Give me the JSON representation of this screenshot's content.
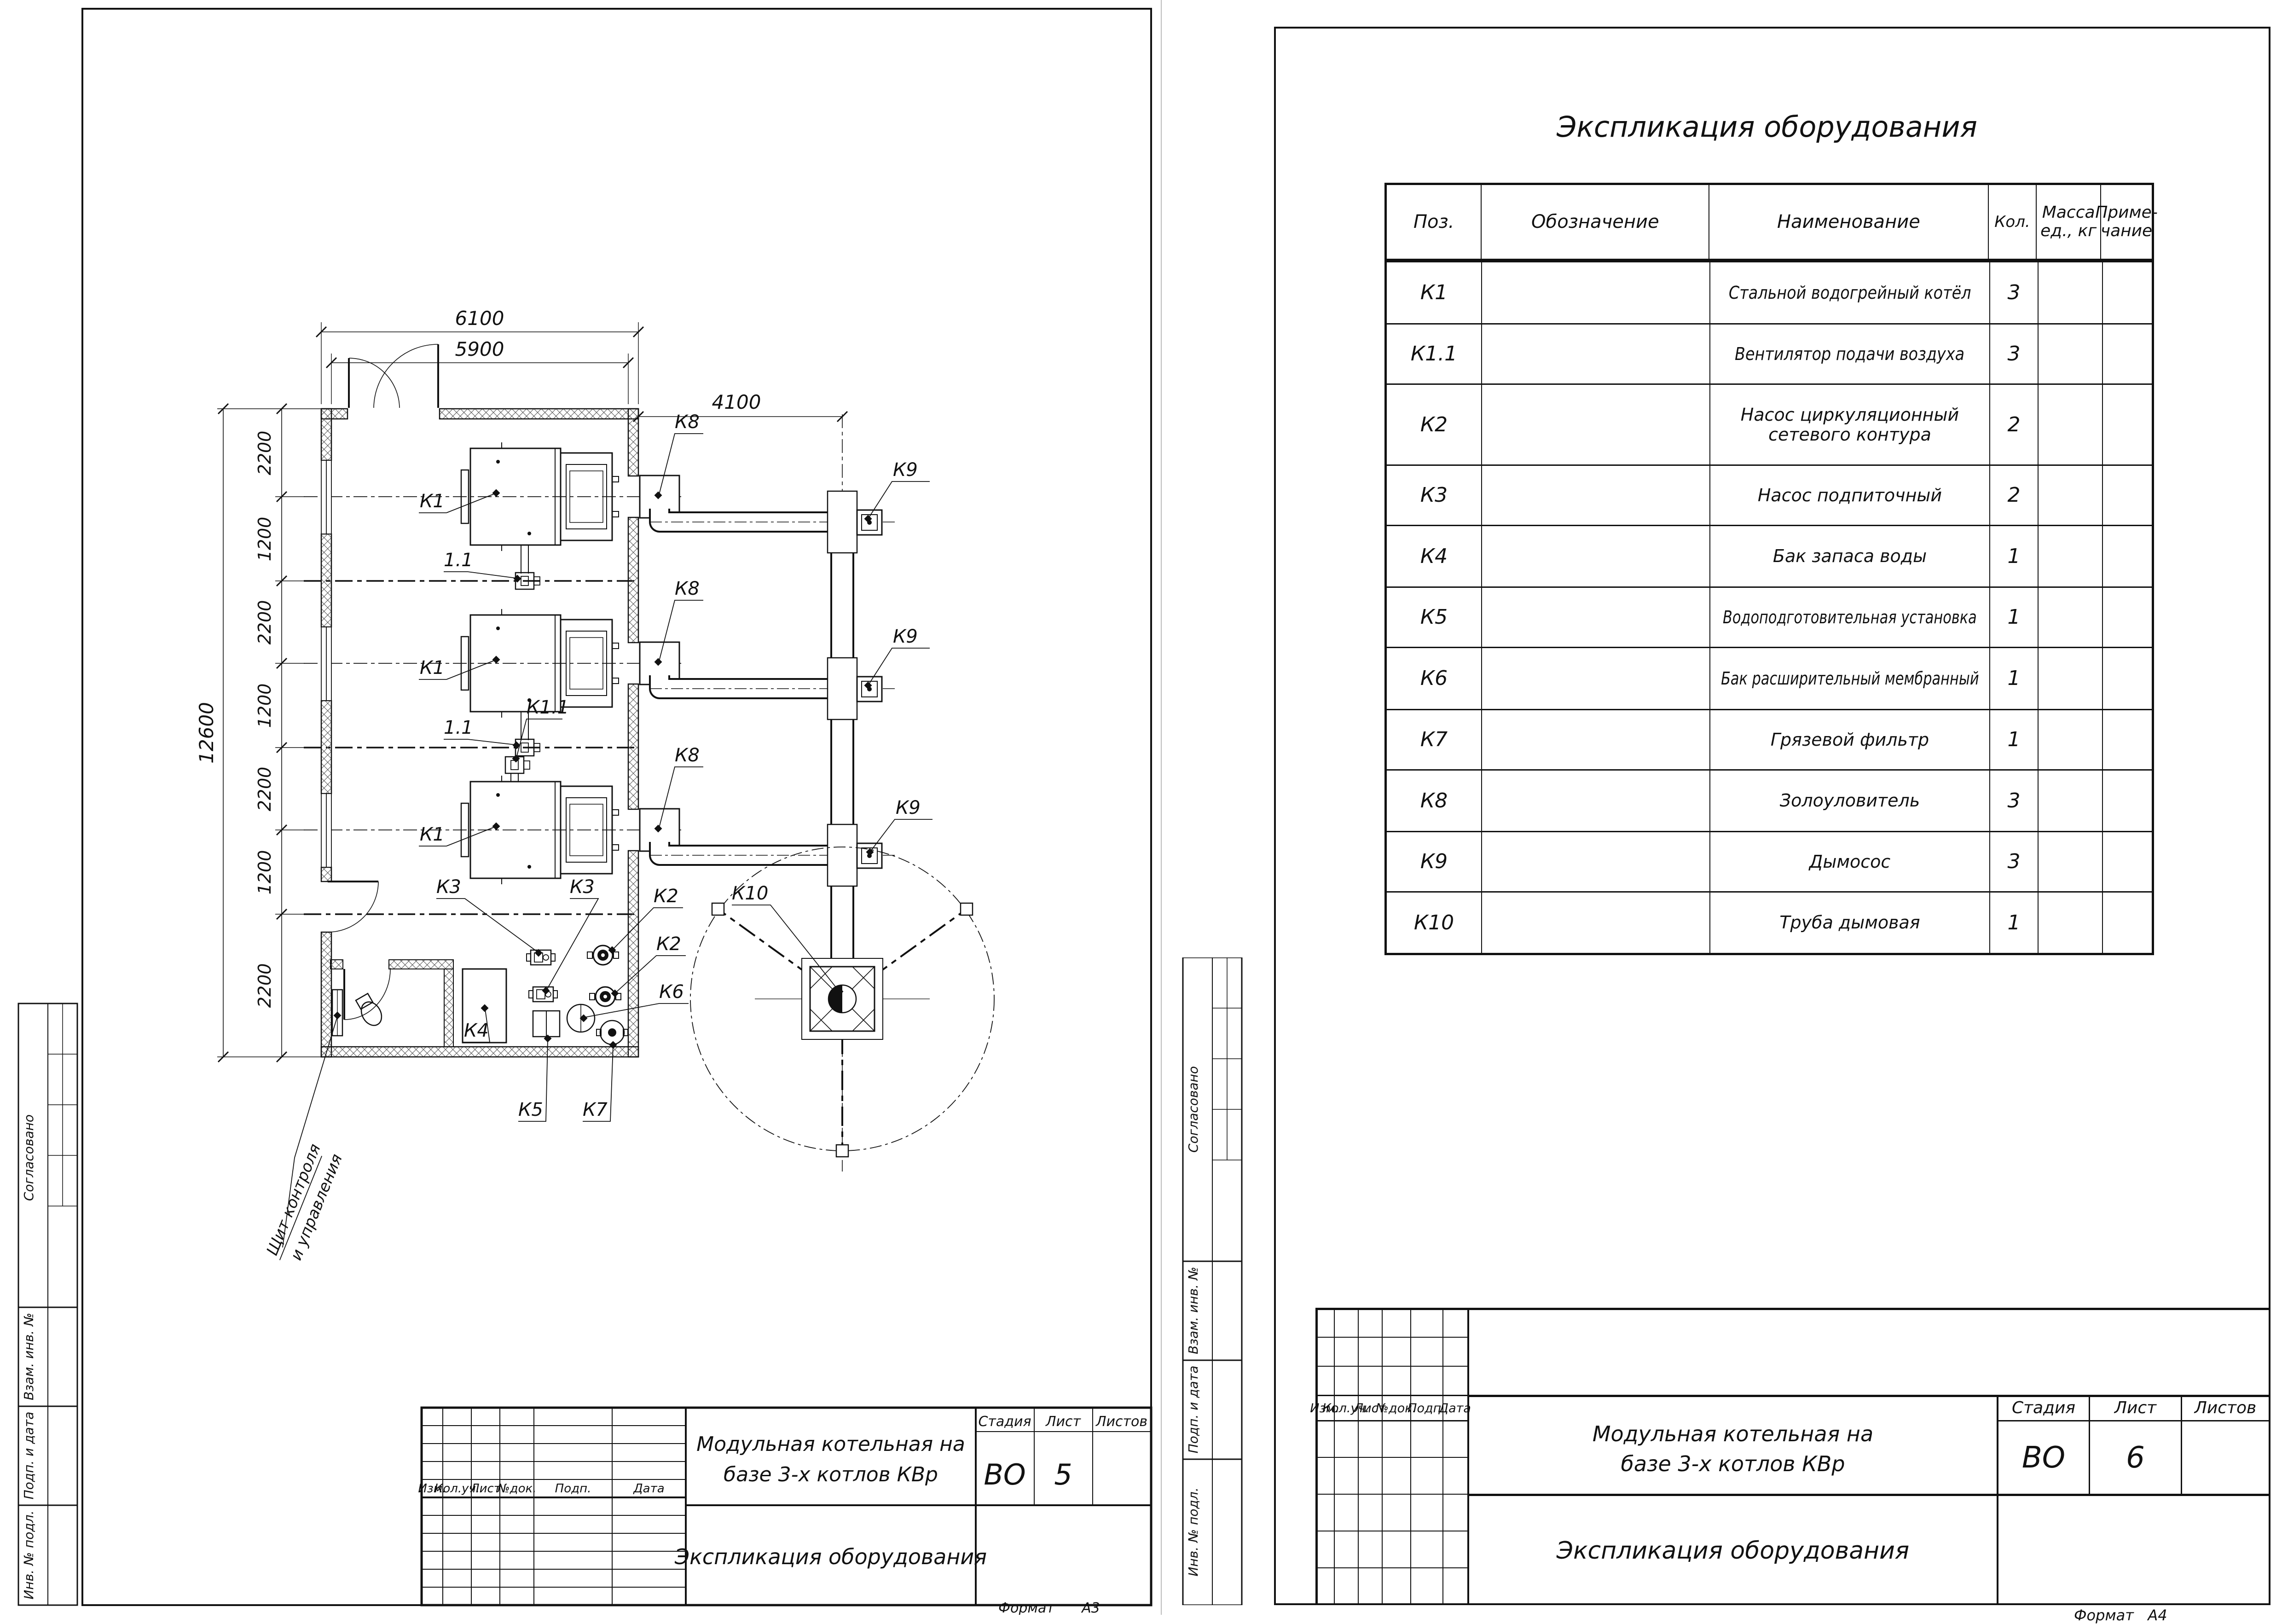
{
  "doc": {
    "project_line1": "Модульная котельная на",
    "project_line2": "базе 3-х котлов КВр",
    "doc_title": "Экспликация оборудования",
    "stage": "ВО",
    "stage_label": "Стадия",
    "sheet_label": "Лист",
    "sheets_label": "Листов",
    "format_label": "Формат"
  },
  "stamps": {
    "s1": "Согласовано",
    "s2": "Взам. инв. №",
    "s3": "Подп. и дата",
    "s4": "Инв. № подл."
  },
  "rev_headers": {
    "h1": "Изм.",
    "h2": "Кол.уч.",
    "h3": "Лист",
    "h4": "№док.",
    "h5": "Подп.",
    "h6": "Дата"
  },
  "left_sheet": {
    "sheet_no": "5",
    "format": "А3",
    "plan": {
      "dim_top": "6100",
      "dim_inner": "5900",
      "dim_flue": "4100",
      "dim_total": "12600",
      "segs": [
        "2200",
        "1200",
        "2200",
        "1200",
        "2200",
        "1200",
        "2200"
      ],
      "labels": {
        "k1": "К1",
        "fan": "1.1",
        "k1_1": "К1.1",
        "k2": "К2",
        "k3": "К3",
        "k4": "К4",
        "k5": "К5",
        "k6": "К6",
        "k7": "К7",
        "k8": "К8",
        "k9": "К9",
        "k10": "К10",
        "panel1": "Щит контроля",
        "panel2": "и управления"
      }
    }
  },
  "right_sheet": {
    "sheet_no": "6",
    "format": "А4",
    "table": {
      "headers": {
        "pos": "Поз.",
        "designation": "Обозначение",
        "name": "Наименование",
        "qty": "Кол.",
        "mass1": "Масса",
        "mass2": "ед., кг",
        "note1": "Приме-",
        "note2": "чание"
      },
      "rows": [
        {
          "pos": "К1",
          "name": "Стальной водогрейный котёл",
          "qty": "3"
        },
        {
          "pos": "К1.1",
          "name": "Вентилятор подачи воздуха",
          "qty": "3"
        },
        {
          "pos": "К2",
          "name": "Насос циркуляционный",
          "name2": "сетевого контура",
          "qty": "2"
        },
        {
          "pos": "К3",
          "name": "Насос подпиточный",
          "qty": "2"
        },
        {
          "pos": "К4",
          "name": "Бак запаса воды",
          "qty": "1"
        },
        {
          "pos": "К5",
          "name": "Водоподготовительная установка",
          "qty": "1"
        },
        {
          "pos": "К6",
          "name": "Бак расширительный мембранный",
          "qty": "1"
        },
        {
          "pos": "К7",
          "name": "Грязевой фильтр",
          "qty": "1"
        },
        {
          "pos": "К8",
          "name": "Золоуловитель",
          "qty": "3"
        },
        {
          "pos": "К9",
          "name": "Дымосос",
          "qty": "3"
        },
        {
          "pos": "К10",
          "name": "Труба дымовая",
          "qty": "1"
        }
      ]
    }
  }
}
